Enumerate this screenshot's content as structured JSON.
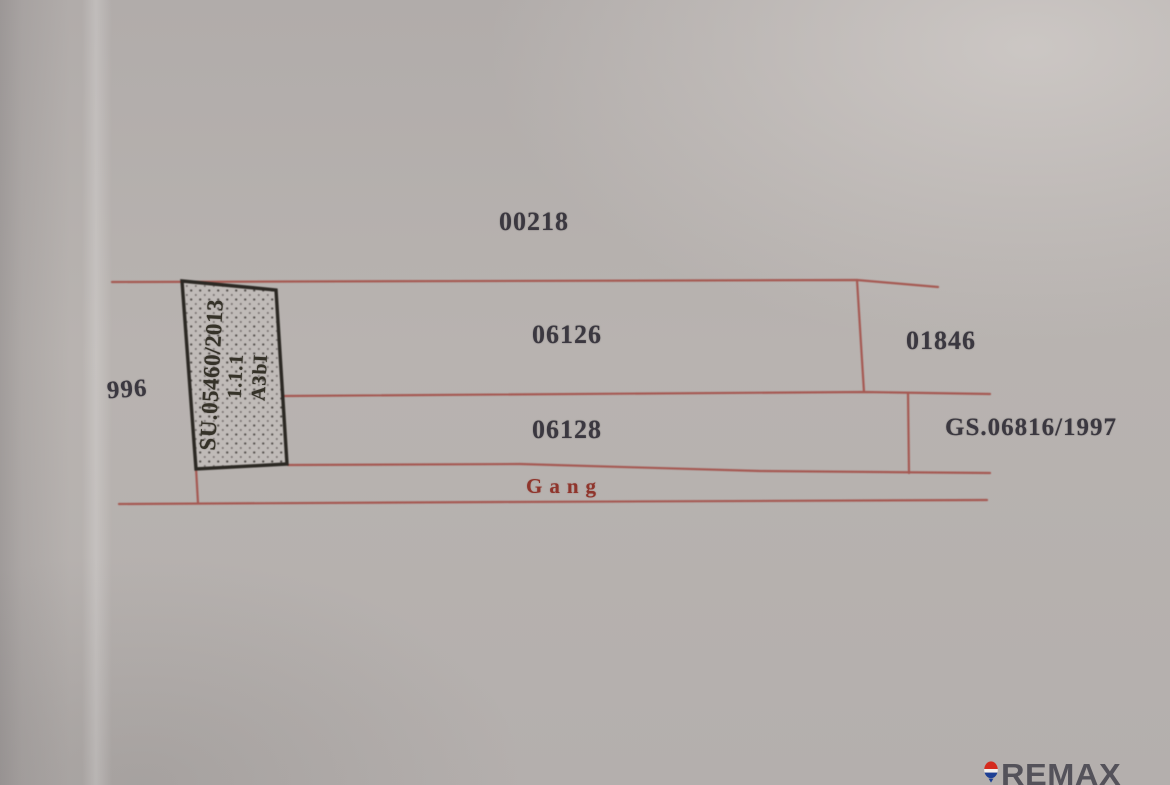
{
  "diagram": {
    "parcels": {
      "top": "00218",
      "upper": "06126",
      "upper_right": "01846",
      "left": "996",
      "lower": "06128",
      "grant_right": "GS.06816/1997",
      "lane": "Gang"
    },
    "survey_block": {
      "line1": "SU.05460/2013",
      "line2": "1.1.1",
      "line3": "A3bI"
    }
  },
  "watermark": {
    "brand": "REMAX",
    "icon": "remax-balloon-icon"
  },
  "colors": {
    "paper": "#b7b2af",
    "boundary_line_red": "#a4524b",
    "lane_text_red": "#8f352c",
    "ink": "#3b3840",
    "block_outline": "#2b2823",
    "watermark_gray": "#54525a",
    "balloon_red": "#d52b1e",
    "balloon_blue": "#1d3f94"
  }
}
